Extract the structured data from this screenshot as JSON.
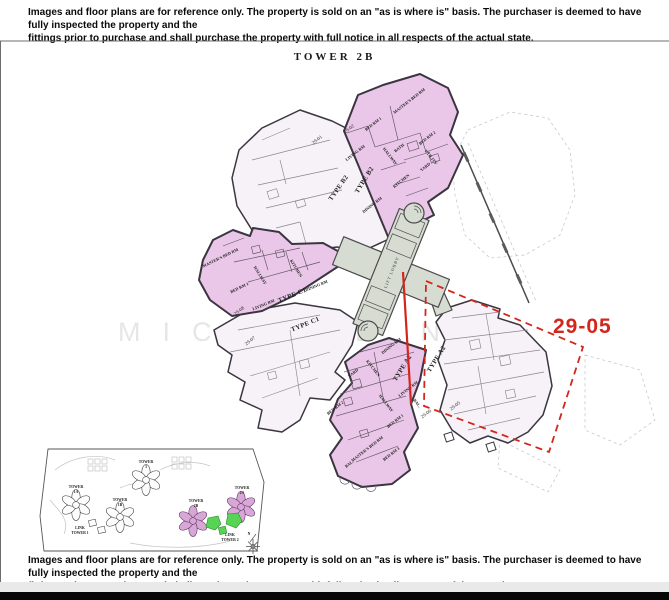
{
  "title": "TOWER 2B",
  "disclaimer": {
    "line1": "Images and floor plans are for reference only. The property is sold on an \"as is where is\" basis. The purchaser is deemed to have fully inspected the property and the",
    "line2": "fittings prior to purchase and shall purchase the property with full notice in all respects of the actual state."
  },
  "watermark": "MICHAEL NG",
  "core": {
    "label": "LIFT LOBBY"
  },
  "highlight": {
    "label": "29-05"
  },
  "units": [
    {
      "no": "29-01",
      "type": "TYPE B2",
      "rooms": []
    },
    {
      "no": "29-02",
      "type": "TYPE B2",
      "rooms": [
        "MASTER'S BED RM",
        "BED RM 1",
        "BED RM 2",
        "LIVING RM",
        "HALLWAY",
        "BATH",
        "UTILITY",
        "YARD",
        "KITCHEN",
        "DINING RM"
      ]
    },
    {
      "no": "29-08",
      "type": "TYPE C1",
      "rooms": [
        "MASTER'S BED RM",
        "BED RM 1",
        "HALLWAY",
        "KITCHEN",
        "LIVING RM",
        "DINING RM"
      ]
    },
    {
      "no": "29-07",
      "type": "TYPE C1",
      "rooms": []
    },
    {
      "no": "29-06",
      "type": "TYPE A2",
      "rooms": [
        "DINING RM",
        "KITCHEN",
        "YARD",
        "LIVING RM",
        "HALLWAY",
        "BED RM 2",
        "BED RM 1",
        "MASTER'S BED RM",
        "BED RM 3",
        "BAL.",
        "BAL."
      ]
    },
    {
      "no": "29-05",
      "type": "TYPE A2",
      "rooms": []
    }
  ],
  "minimap": {
    "towers": [
      {
        "line1": "TOWER",
        "line2": "3"
      },
      {
        "line1": "TOWER",
        "line2": "1A"
      },
      {
        "line1": "TOWER",
        "line2": "1B"
      },
      {
        "line1": "TOWER",
        "line2": "2B"
      },
      {
        "line1": "TOWER",
        "line2": "2A"
      },
      {
        "line1": "LINK",
        "line2": "TOWER 1"
      },
      {
        "line1": "LINK",
        "line2": "TOWER 2"
      }
    ],
    "compass_label": "N"
  },
  "colors": {
    "unit_pink": "#eac7e8",
    "unit_white": "#f6f2f7",
    "core_gray": "#d7dcd3",
    "wall": "#3b3540",
    "red": "#d3261c",
    "minimap_pink": "#d8a7d7",
    "minimap_green": "#57d356",
    "watermark": "#d6d6d6"
  }
}
